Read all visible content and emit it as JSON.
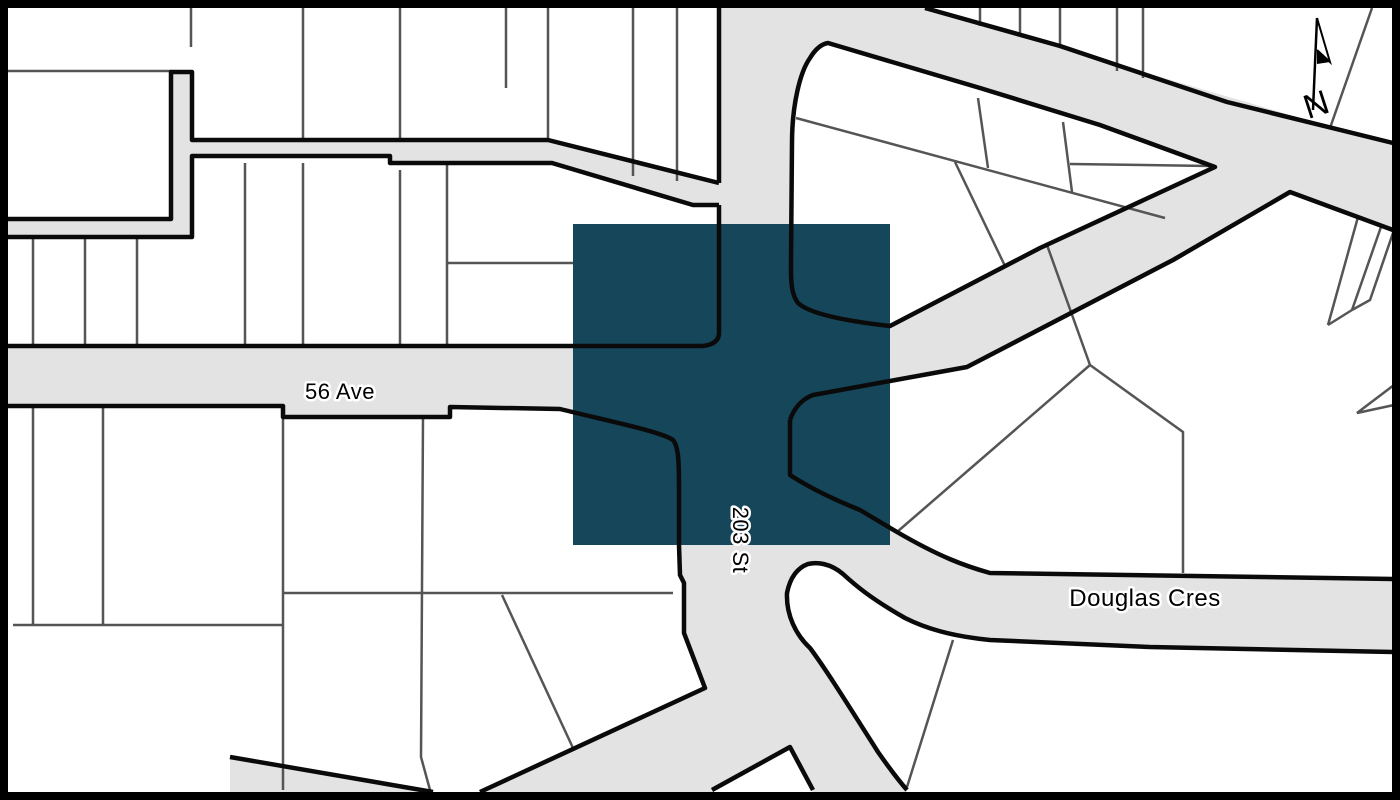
{
  "map": {
    "type": "cadastral-street-map",
    "labels": {
      "ave56": "56 Ave",
      "st203": "203 St",
      "douglas": "Douglas Cres"
    },
    "north_arrow": {
      "letter": "N"
    },
    "colors": {
      "road_fill": "#e3e3e3",
      "road_casing": "#0a0a0a",
      "parcel_line": "#555555",
      "highlight_square": "#15465a",
      "background": "#ffffff",
      "border": "#000000"
    },
    "highlight": {
      "x": 573,
      "y": 224,
      "width": 317,
      "height": 321
    }
  }
}
